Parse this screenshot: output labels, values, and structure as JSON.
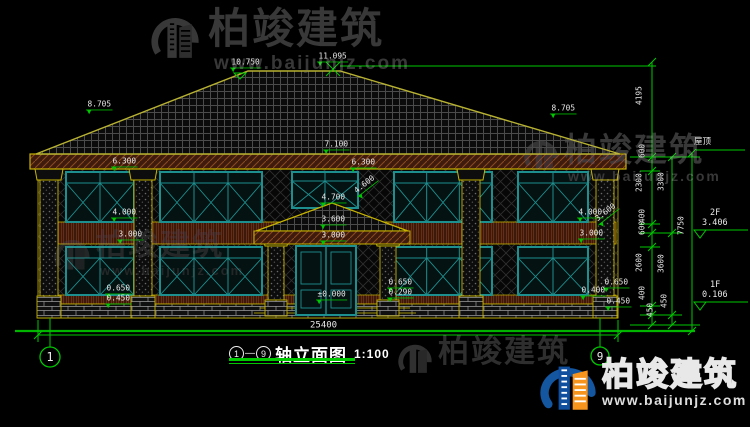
{
  "brand": {
    "name": "柏竣建筑",
    "url": "www.baijunjz.com"
  },
  "watermarks": {
    "top_left": {
      "brand": "柏竣建筑",
      "url": "www.baijunjz.com"
    },
    "mid_right": {
      "brand": "柏竣建筑",
      "url": "www.baijunjz.com"
    },
    "center": {
      "brand": "柏竣建筑",
      "url": "www.baijunjz.com"
    },
    "bottom_gray": {
      "brand": "柏竣建筑"
    },
    "bottom_right": {
      "brand": "柏竣建筑",
      "url": "www.baijunjz.com"
    }
  },
  "title_block": {
    "axis_start": "1",
    "separator": "—",
    "axis_end": "9",
    "title": "轴立面图",
    "scale": "1:100"
  },
  "axis_bubbles": {
    "left": "1",
    "right": "9"
  },
  "dimensions": {
    "overall_width": {
      "t": "25400",
      "x": 310,
      "y": 321
    },
    "spot_elevations": [
      {
        "t": "10.750",
        "x": 230,
        "y": 59
      },
      {
        "t": "11.095",
        "x": 317,
        "y": 53
      },
      {
        "t": "8.705",
        "x": 86,
        "y": 101
      },
      {
        "t": "8.705",
        "x": 550,
        "y": 105
      },
      {
        "t": "7.100",
        "x": 323,
        "y": 141
      },
      {
        "t": "6.300",
        "x": 350,
        "y": 159
      },
      {
        "t": "6.300",
        "x": 111,
        "y": 158
      },
      {
        "t": "4.000",
        "x": 111,
        "y": 209
      },
      {
        "t": "3.000",
        "x": 117,
        "y": 231
      },
      {
        "t": "4.700",
        "x": 320,
        "y": 194
      },
      {
        "t": "4.600",
        "x": 352,
        "y": 190,
        "rot": -38
      },
      {
        "t": "3.600",
        "x": 320,
        "y": 216
      },
      {
        "t": "3.000",
        "x": 320,
        "y": 232
      },
      {
        "t": "±0.000",
        "x": 316,
        "y": 291
      },
      {
        "t": "0.650",
        "x": 387,
        "y": 279
      },
      {
        "t": "0.290",
        "x": 387,
        "y": 289
      },
      {
        "t": "0.650",
        "x": 105,
        "y": 285
      },
      {
        "t": "0.450",
        "x": 105,
        "y": 295
      },
      {
        "t": "4.000",
        "x": 577,
        "y": 209
      },
      {
        "t": "3.600",
        "x": 593,
        "y": 218,
        "rot": -38
      },
      {
        "t": "3.000",
        "x": 578,
        "y": 230
      },
      {
        "t": "0.650",
        "x": 603,
        "y": 279
      },
      {
        "t": "0.400",
        "x": 580,
        "y": 287
      },
      {
        "t": "0.450",
        "x": 605,
        "y": 298
      }
    ],
    "chain": [
      {
        "t": "4195",
        "x": 648,
        "y": 110
      },
      {
        "t": "600",
        "x": 648,
        "y": 163
      },
      {
        "t": "2300",
        "x": 648,
        "y": 197
      },
      {
        "t": "400",
        "x": 648,
        "y": 228
      },
      {
        "t": "600",
        "x": 648,
        "y": 240
      },
      {
        "t": "2600",
        "x": 648,
        "y": 277
      },
      {
        "t": "400",
        "x": 648,
        "y": 305
      },
      {
        "t": "450",
        "x": 656,
        "y": 322
      },
      {
        "t": "3300",
        "x": 670,
        "y": 196
      },
      {
        "t": "3600",
        "x": 670,
        "y": 278
      },
      {
        "t": "450",
        "x": 670,
        "y": 313
      },
      {
        "t": "7750",
        "x": 690,
        "y": 240
      }
    ],
    "levels": [
      {
        "t": "屋顶",
        "x": 694,
        "y": 138
      },
      {
        "t": "2F",
        "x": 710,
        "y": 209
      },
      {
        "t": "3.406",
        "x": 702,
        "y": 219
      },
      {
        "t": "1F",
        "x": 710,
        "y": 281
      },
      {
        "t": "0.106",
        "x": 702,
        "y": 291
      }
    ]
  },
  "colors": {
    "dim_green": "#00c800",
    "ground_green": "#00b400",
    "trim_yellow": "#c8b400",
    "window_teal": "#1e8f8f",
    "band_brown": "#3f1b0d",
    "logo_blue": "#1456a0",
    "logo_orange": "#f7941d"
  }
}
